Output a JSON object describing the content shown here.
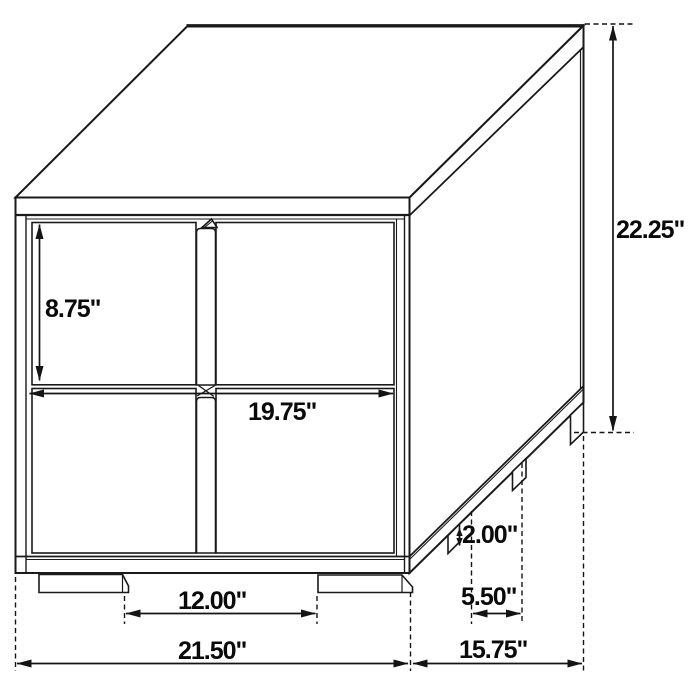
{
  "diagram": {
    "kind": "furniture-dimension-line-drawing",
    "subject": "two-drawer nightstand, isometric view",
    "unit": "inches",
    "background_color": "#ffffff",
    "line_color": "#1a1a1a"
  },
  "labels": {
    "drawer_height": "8.75\"",
    "overall_height": "22.25\"",
    "drawer_width": "19.75\"",
    "leg_height": "2.00\"",
    "side_leg_spacing": "5.50\"",
    "front_leg_spacing": "12.00\"",
    "overall_width": "21.50\"",
    "overall_depth": "15.75\""
  },
  "measurements": [
    {
      "name": "drawer front height",
      "value": 8.75
    },
    {
      "name": "overall height",
      "value": 22.25
    },
    {
      "name": "drawer front width",
      "value": 19.75
    },
    {
      "name": "leg height",
      "value": 2.0
    },
    {
      "name": "side leg spacing",
      "value": 5.5
    },
    {
      "name": "front leg spacing",
      "value": 12.0
    },
    {
      "name": "overall width",
      "value": 21.5
    },
    {
      "name": "overall depth",
      "value": 15.75
    }
  ]
}
